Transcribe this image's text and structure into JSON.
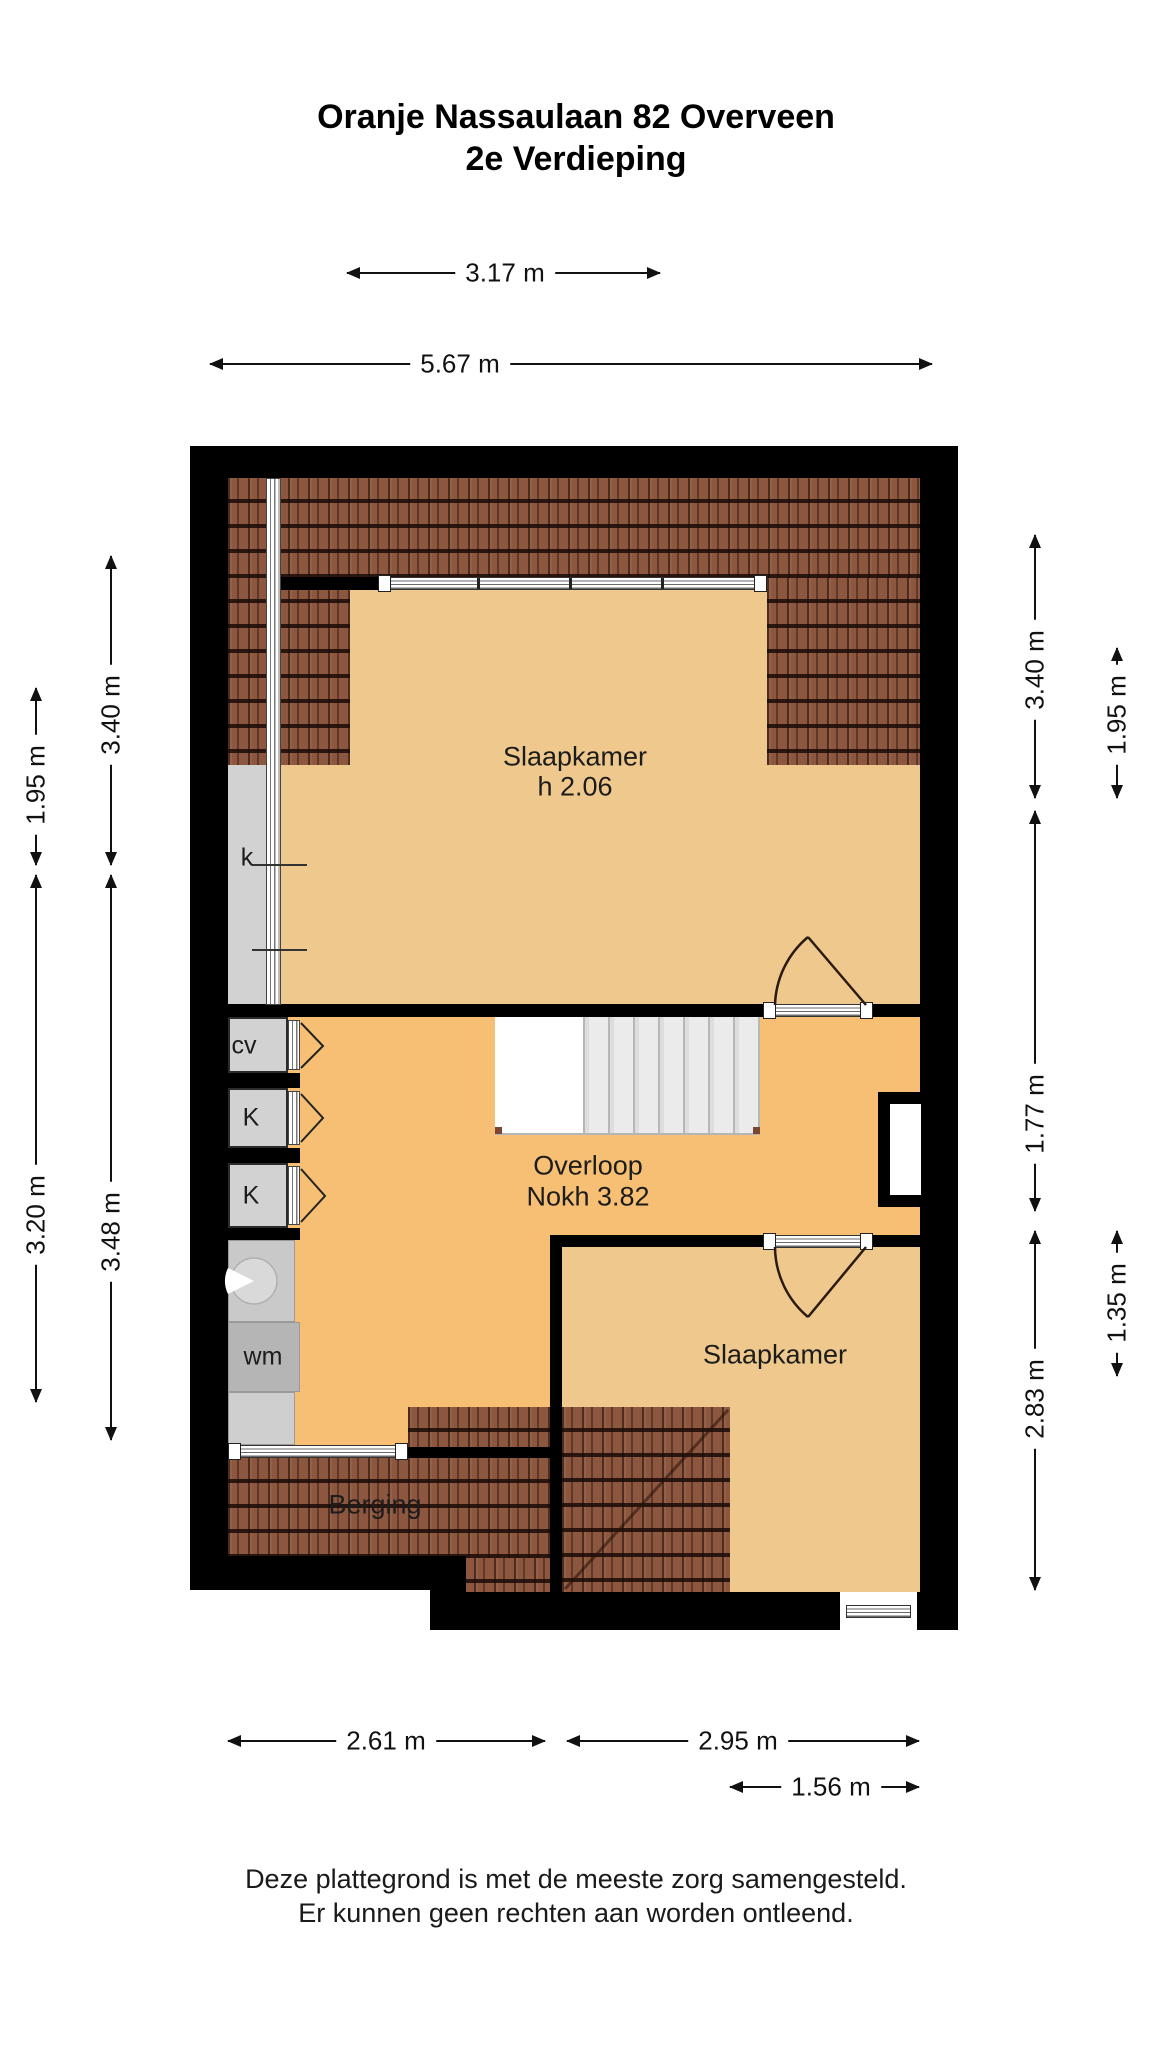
{
  "title": {
    "line1": "Oranje Nassaulaan 82 Overveen",
    "line2": "2e Verdieping"
  },
  "rooms": {
    "bedroom_top": {
      "name": "Slaapkamer",
      "sub": "h 2.06"
    },
    "landing": {
      "name": "Overloop",
      "sub": "Nokh 3.82"
    },
    "bedroom_bottom": {
      "name": "Slaapkamer"
    },
    "storage": {
      "name": "Berging"
    }
  },
  "fixtures": {
    "dormer_window": "k",
    "heater_closet": "cv",
    "closet_1": "K",
    "closet_2": "K",
    "washing_machine": "wm"
  },
  "dimensions": {
    "top_317": "3.17 m",
    "top_567": "5.67 m",
    "left_340": "3.40 m",
    "left_195": "1.95 m",
    "left_320": "3.20 m",
    "left_348": "3.48 m",
    "right_340": "3.40 m",
    "right_195": "1.95 m",
    "right_177": "1.77 m",
    "right_135": "1.35 m",
    "right_283": "2.83 m",
    "bottom_261": "2.61 m",
    "bottom_295": "2.95 m",
    "bottom_156": "1.56 m"
  },
  "footer": {
    "line1": "Deze plattegrond is met de meeste zorg samengesteld.",
    "line2": "Er kunnen geen rechten aan worden ontleend."
  },
  "colors": {
    "wall": "#000000",
    "floor_bedroom": "#eec88c",
    "floor_landing": "#f6bf74",
    "roof": "#8d573f",
    "closet": "#d2d2d2",
    "washer": "#b5b5b5",
    "shower": "#c9c9c9",
    "accent_text": "#1c1c1c"
  }
}
